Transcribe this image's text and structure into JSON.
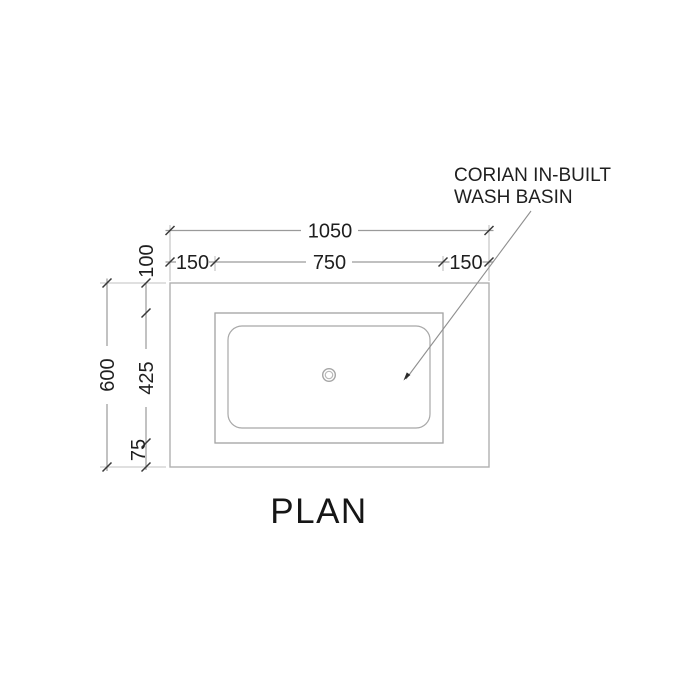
{
  "drawing": {
    "title": "PLAN",
    "annotation": {
      "line1": "CORIAN IN-BUILT",
      "line2": "WASH BASIN"
    },
    "dimensions": {
      "top_total": "1050",
      "top_left": "150",
      "top_middle": "750",
      "top_right": "150",
      "side_total": "600",
      "side_top": "100",
      "side_middle": "425",
      "side_bottom": "75"
    },
    "colors": {
      "background": "#ffffff",
      "outline": "#b0b0b0",
      "basin_outline": "#a2a2a2",
      "bowl_outline": "#a8a8a8",
      "dimension_line": "#9a9a9a",
      "extension_line": "#c0c0c0",
      "tick": "#383838",
      "text": "#1f1f1f",
      "leader": "#8f8f8f"
    }
  }
}
